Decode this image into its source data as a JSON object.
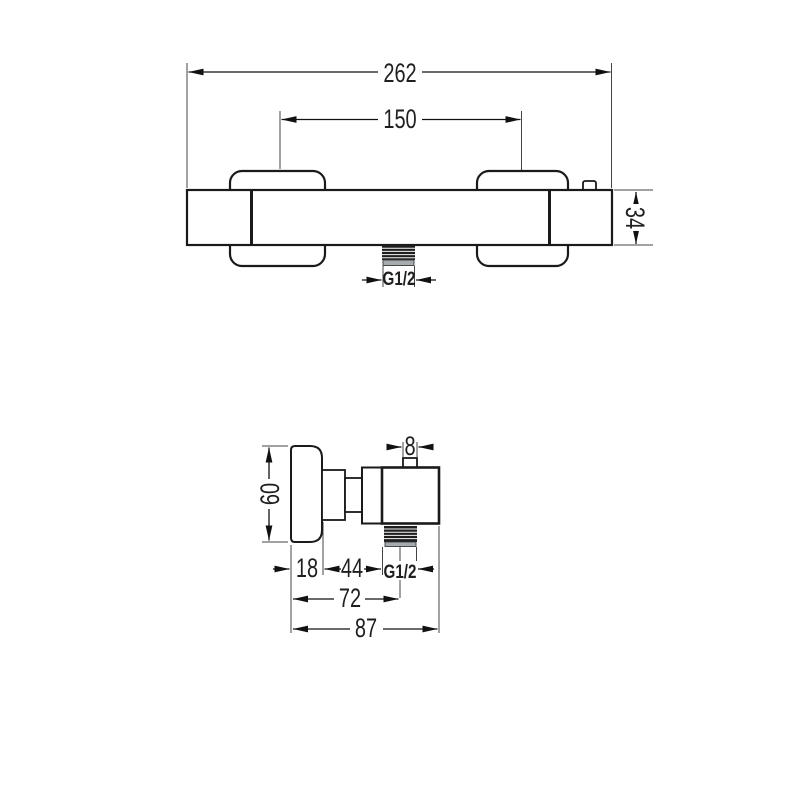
{
  "drawing": {
    "front_view": {
      "overall_width": "262",
      "handle_spacing": "150",
      "body_height": "34",
      "outlet_thread": "G1/2"
    },
    "side_view": {
      "button_width": "8",
      "handle_diameter": "60",
      "handle_depth": "18",
      "body_depth": "44",
      "outlet_thread": "G1/2",
      "depth_to_outlet": "72",
      "overall_depth": "87"
    },
    "colors": {
      "outline": "#1a1a1a",
      "dimension_line": "#111111",
      "extension_line": "#444444",
      "background": "#ffffff",
      "thread_dark": "#1e1e1e",
      "thread_base": "#a6abb0"
    }
  }
}
